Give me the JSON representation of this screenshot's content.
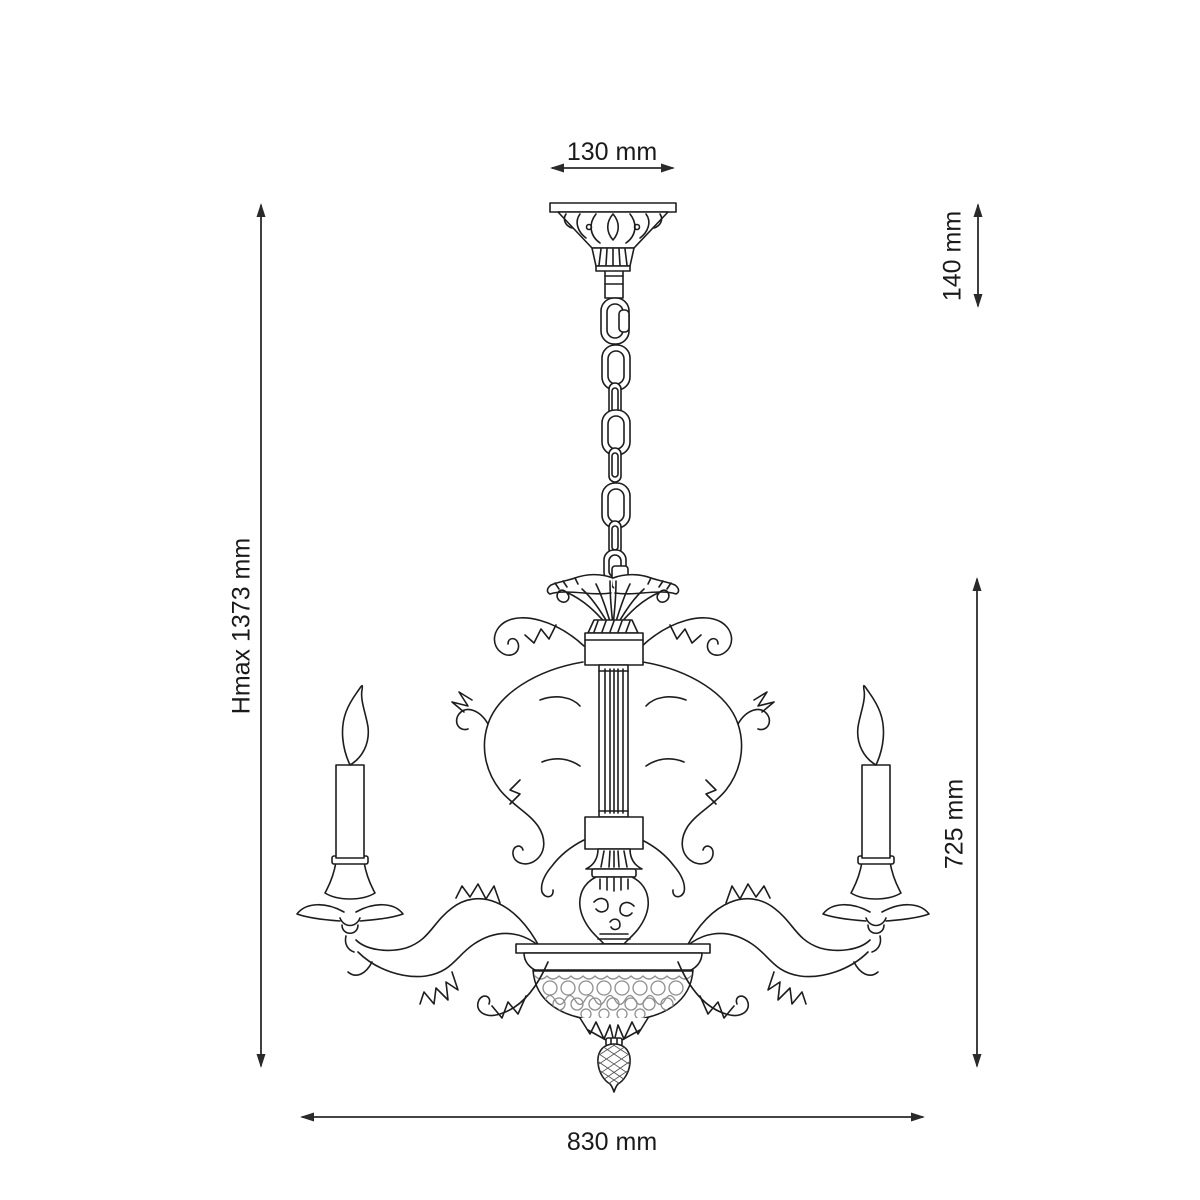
{
  "drawing": {
    "subject": "Chandelier technical dimension drawing",
    "style": "black line art on white background",
    "units": "mm"
  },
  "dimensions": {
    "canopy_width": "130 mm",
    "suspension_height": "140 mm",
    "max_height": "Hmax 1373 mm",
    "body_height": "725 mm",
    "body_width": "830 mm"
  },
  "colors": {
    "background": "#ffffff",
    "line": "#1d1d1d",
    "dimension_line": "#2a2a2a",
    "label_text": "#1a1a1a",
    "filigree": "#8f8f8f"
  }
}
